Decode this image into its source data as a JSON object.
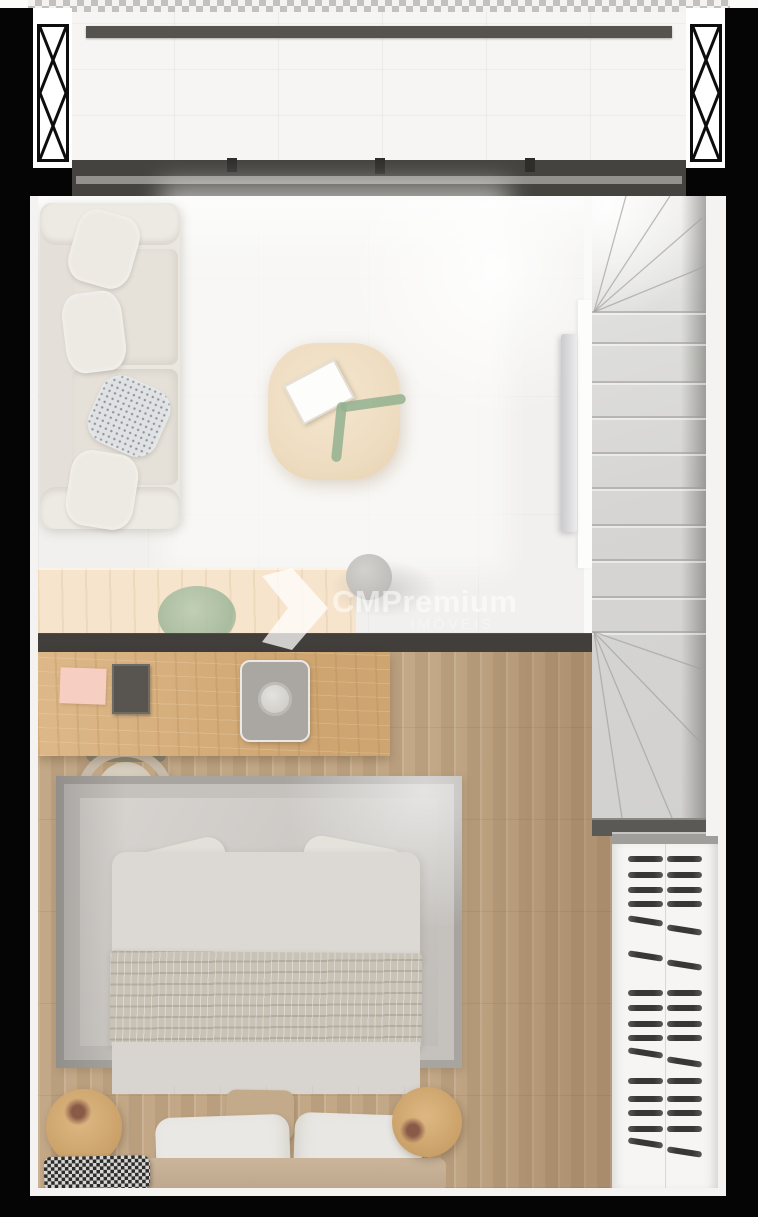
{
  "watermark": {
    "brand": "CMPremium",
    "subtitle": "IMÓVEIS",
    "logo": "chevron-arrow-logo"
  },
  "palette": {
    "background": "#000000",
    "wall_dark": "#413e3b",
    "window_frame": "#45433f",
    "balcony_floor": "#f6f5f3",
    "living_floor": "#f1f0ee",
    "sofa": "#eae7e0",
    "coffee_table_wood": "#eedcc0",
    "counter_wood": "#d8ae78",
    "bedroom_wood_floor": "#c9af8e",
    "stairs_concrete": "#d6d5d3",
    "rug_gray": "#c8c5c1",
    "bed_linen": "#dcd9d4",
    "throw_blanket": "#c9c3b7",
    "headboard": "#c5af95",
    "stool_wood": "#cfa76e",
    "wardrobe_white": "#f6f5f3",
    "hanger_dark": "#3b3937",
    "plant_green": "#9db697",
    "notepad_pink": "#f6cfc2"
  },
  "stairs": {
    "width": 114,
    "height": 640,
    "treads_y": [
      116,
      147,
      186,
      221,
      257,
      292,
      329,
      364,
      401,
      436
    ],
    "top_fan_origin": [
      2,
      116
    ],
    "top_fan_targets": [
      [
        34,
        0
      ],
      [
        78,
        0
      ],
      [
        110,
        22
      ],
      [
        114,
        70
      ]
    ],
    "bottom_fan_origin": [
      2,
      436
    ],
    "bottom_fan_targets": [
      [
        112,
        474
      ],
      [
        112,
        550
      ],
      [
        80,
        622
      ],
      [
        30,
        622
      ]
    ],
    "bottom_edge_y": 622
  },
  "wardrobe": {
    "hangers": [
      {
        "y": 856,
        "t": "h"
      },
      {
        "y": 872,
        "t": "h"
      },
      {
        "y": 887,
        "t": "h"
      },
      {
        "y": 901,
        "t": "h"
      },
      {
        "y": 918,
        "t": "d"
      },
      {
        "y": 953,
        "t": "d"
      },
      {
        "y": 990,
        "t": "h"
      },
      {
        "y": 1005,
        "t": "h"
      },
      {
        "y": 1021,
        "t": "h"
      },
      {
        "y": 1035,
        "t": "h"
      },
      {
        "y": 1050,
        "t": "d"
      },
      {
        "y": 1078,
        "t": "h"
      },
      {
        "y": 1096,
        "t": "h"
      },
      {
        "y": 1110,
        "t": "h"
      },
      {
        "y": 1126,
        "t": "h"
      },
      {
        "y": 1140,
        "t": "d"
      }
    ]
  }
}
